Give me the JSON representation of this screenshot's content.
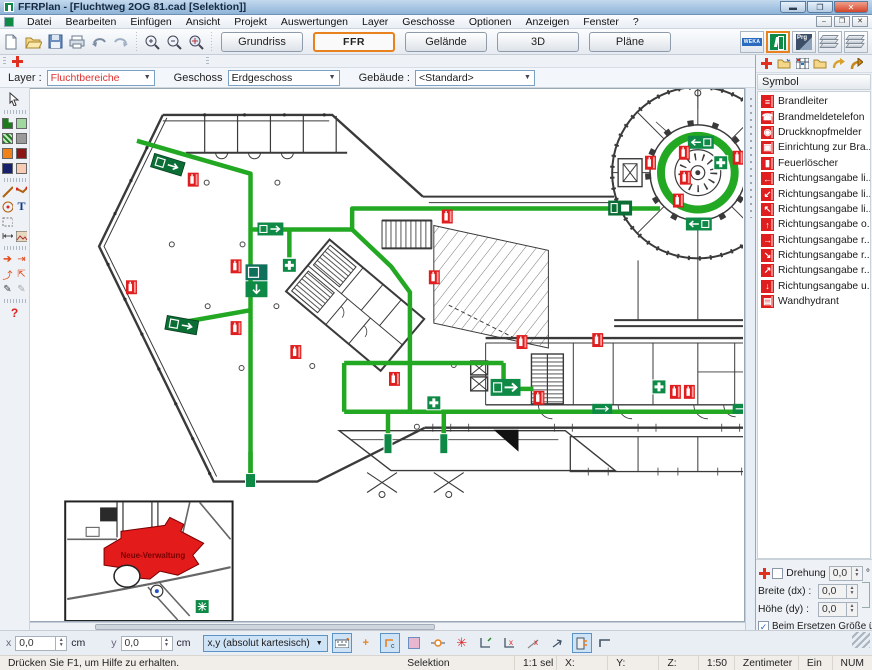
{
  "window": {
    "title": "FFRPlan - [Fluchtweg 2OG 81.cad [Selektion]]"
  },
  "menu": {
    "items": [
      "Datei",
      "Bearbeiten",
      "Einfügen",
      "Ansicht",
      "Projekt",
      "Auswertungen",
      "Layer",
      "Geschosse",
      "Optionen",
      "Anzeigen",
      "Fenster",
      "?"
    ]
  },
  "toolbar": {
    "view_buttons": [
      "Grundriss",
      "FFR",
      "Gelände",
      "3D",
      "Pläne"
    ],
    "active_view": "FFR",
    "weka_label": "WEKA",
    "prg_label": "Prg"
  },
  "layerbar": {
    "layer_label": "Layer :",
    "layer_value": "Fluchtbereiche",
    "geschoss_label": "Geschoss",
    "geschoss_value": "Erdgeschoss",
    "gebaeude_label": "Gebäude :",
    "gebaeude_value": "<Standard>"
  },
  "tools": {
    "text_tool": "T",
    "help_tool": "?"
  },
  "symbol_panel": {
    "header": "Symbol",
    "items": [
      {
        "label": "Brandleiter",
        "glyph": "≡"
      },
      {
        "label": "Brandmeldetelefon",
        "glyph": "☎"
      },
      {
        "label": "Druckknopfmelder",
        "glyph": "◉"
      },
      {
        "label": "Einrichtung zur Bra...",
        "glyph": "▣"
      },
      {
        "label": "Feuerlöscher",
        "glyph": "▮"
      },
      {
        "label": "Richtungsangabe li...",
        "glyph": "←"
      },
      {
        "label": "Richtungsangabe li...",
        "glyph": "↙"
      },
      {
        "label": "Richtungsangabe li...",
        "glyph": "↖"
      },
      {
        "label": "Richtungsangabe o...",
        "glyph": "↑"
      },
      {
        "label": "Richtungsangabe r...",
        "glyph": "→"
      },
      {
        "label": "Richtungsangabe r...",
        "glyph": "↘"
      },
      {
        "label": "Richtungsangabe r...",
        "glyph": "↗"
      },
      {
        "label": "Richtungsangabe u...",
        "glyph": "↓"
      },
      {
        "label": "Wandhydrant",
        "glyph": "▤"
      }
    ]
  },
  "properties": {
    "drehung_label": "Drehung",
    "drehung_value": "0,0",
    "drehung_unit": "°",
    "breite_label": "Breite (dx) :",
    "breite_value": "0,0",
    "hoehe_label": "Höhe (dy) :",
    "hoehe_value": "0,0",
    "replace_label": "Beim Ersetzen Größe übernehm"
  },
  "coordbar": {
    "x_label": "x",
    "x_value": "0,0",
    "x_unit": "cm",
    "y_label": "y",
    "y_value": "0,0",
    "y_unit": "cm",
    "mode_value": "x,y (absolut kartesisch)"
  },
  "statusbar": {
    "help": "Drücken Sie F1, um Hilfe zu erhalten.",
    "mode": "Selektion",
    "sel": "1:1 sel",
    "x": "X:",
    "y": "Y:",
    "z": "Z:",
    "scale": "1:50",
    "unit": "Zentimeter",
    "ein": "Ein",
    "num": "NUM"
  },
  "canvas": {
    "inset_label": "Neue-Verwaltung"
  },
  "colors": {
    "accent_orange": "#e8821e",
    "route_green": "#22a822",
    "symbol_red": "#df1f1f",
    "symbol_green": "#0e8a46",
    "selection_blue": "#cfe3f7"
  }
}
